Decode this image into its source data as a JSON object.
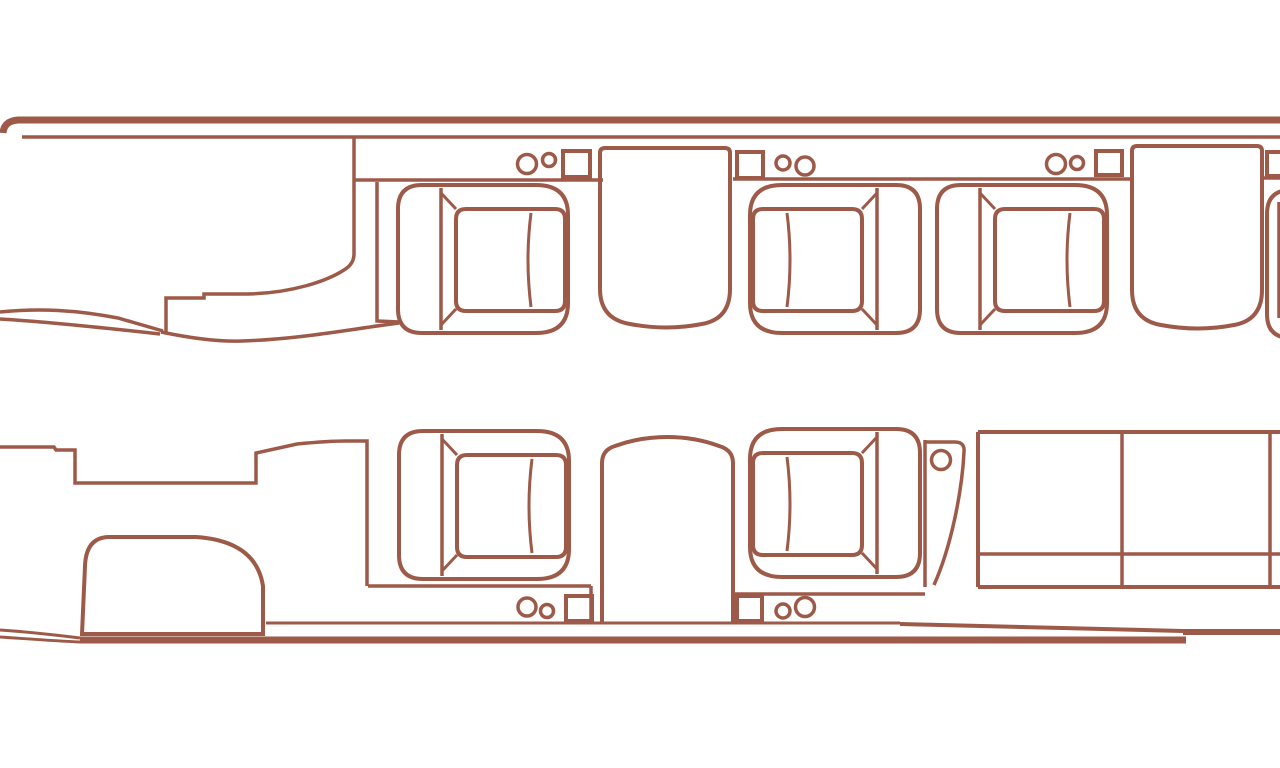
{
  "page": {
    "title": "Aircraft cabin floor plan (top view)",
    "background": "#ffffff"
  },
  "colors": {
    "outline": "#9d5a48",
    "outline_bold": "#8f5646",
    "background": "#ffffff"
  },
  "diagram": {
    "type": "floorplan",
    "description": "Outline line-drawing of a business-jet cabin viewed from above: tapered nose with cockpit partition at left, entry recess on the lower wall, a rounded cabinet forward-left, five single club seats (two facing pairs across side tables plus one mid-cabin seat), a third side table, a curved partition with a cup holder, a three-cushion divan at the aft right, and sidewall consoles holding paired cup holders and small square panels. A sixth seat and console square are cropped by the right edge.",
    "objects": {
      "fuselage": {
        "label": "fuselage outline"
      },
      "cockpit_partition": {
        "label": "cockpit and galley partition"
      },
      "entry_door": {
        "label": "entry door recess in lower wall"
      },
      "forward_cabinet": {
        "label": "rounded forward cabinet"
      },
      "forward_wall": {
        "label": "forward cabin wall segment"
      },
      "seats": [
        {
          "label": "club seat 1, upper row, facing right"
        },
        {
          "label": "club seat 2, upper row, facing left"
        },
        {
          "label": "club seat 3, upper row, facing right"
        },
        {
          "label": "club seat 4, lower row, facing right"
        },
        {
          "label": "club seat 5, lower row, facing left"
        },
        {
          "label": "partial seat cropped at right edge"
        }
      ],
      "tables": [
        {
          "label": "side table between seats 1 and 2"
        },
        {
          "label": "side table right of seat 3"
        },
        {
          "label": "arched side table between seats 4 and 5"
        }
      ],
      "divan": {
        "label": "three-cushion divan, lower right",
        "cushions": 3
      },
      "curved_partition": {
        "label": "curved partition with single cup holder"
      },
      "cupholders": {
        "label": "paired cup-holder circles on sidewall consoles",
        "groups": 5,
        "circles": 11
      },
      "panels": {
        "label": "small square sidewall panels",
        "count": 6
      },
      "consoles": {
        "label": "sidewall console ledges along upper and lower walls"
      }
    }
  }
}
